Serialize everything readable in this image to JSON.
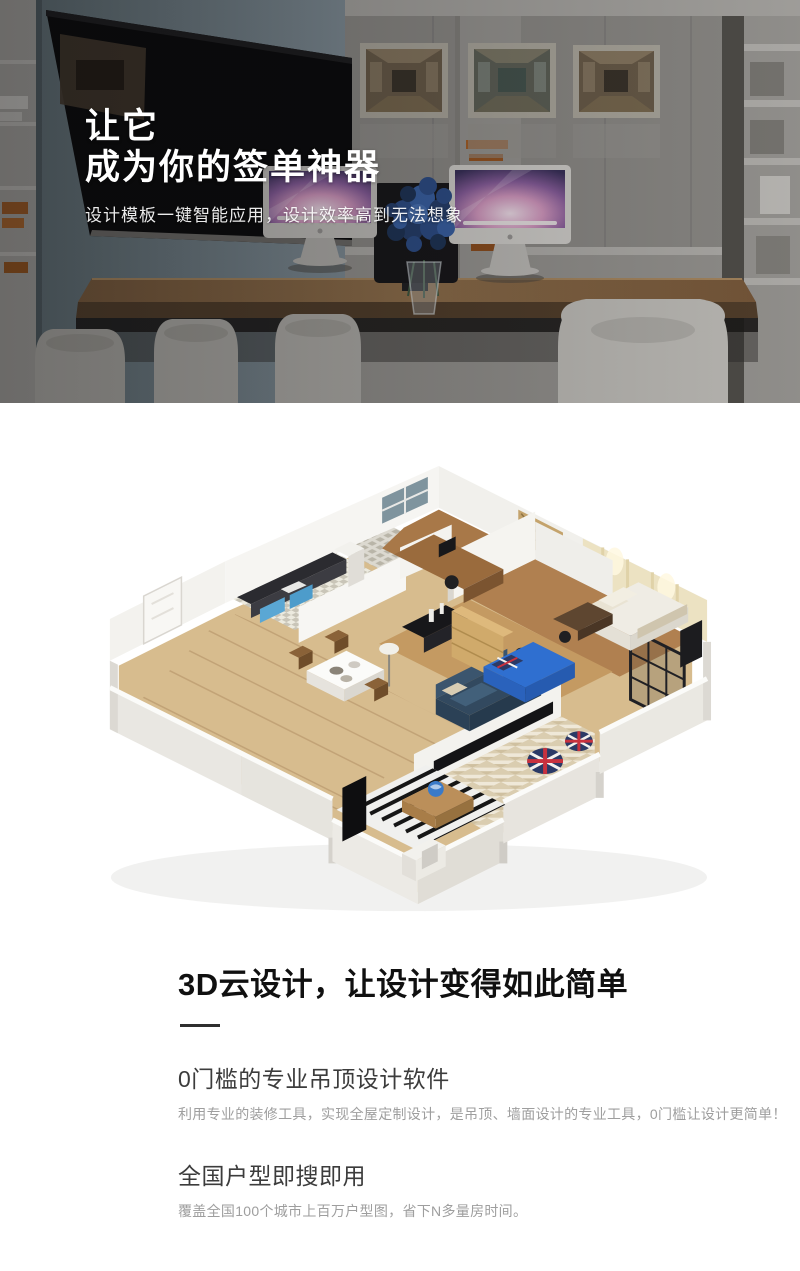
{
  "hero": {
    "title_line1": "让它",
    "title_line2": "成为你的签单神器",
    "subtitle": "设计模板一键智能应用，设计效率高到无法想象",
    "image_name": "office-showroom-photo-with-two-imacs"
  },
  "section": {
    "heading": "3D云设计，让设计变得如此简单",
    "features": [
      {
        "title": "0门槛的专业吊顶设计软件",
        "desc": "利用专业的装修工具，实现全屋定制设计，是吊顶、墙面设计的专业工具，0门槛让设计更简单！"
      },
      {
        "title": "全国户型即搜即用",
        "desc": "覆盖全国100个城市上百万户型图，省下N多量房时间。"
      }
    ],
    "illustration_name": "3d-isometric-apartment-floorplan"
  },
  "colors": {
    "page_bg": "#ffffff",
    "hero_text": "#ffffff",
    "heading_text": "#101010",
    "feature_title": "#3c3c3c",
    "feature_desc": "#9e9e9e",
    "divider": "#2f2f2f",
    "sofa_navy": "#32495f",
    "kids_bed_blue": "#2f6fd0",
    "union_jack_red": "#c8313e",
    "union_jack_navy": "#2b3a66"
  }
}
